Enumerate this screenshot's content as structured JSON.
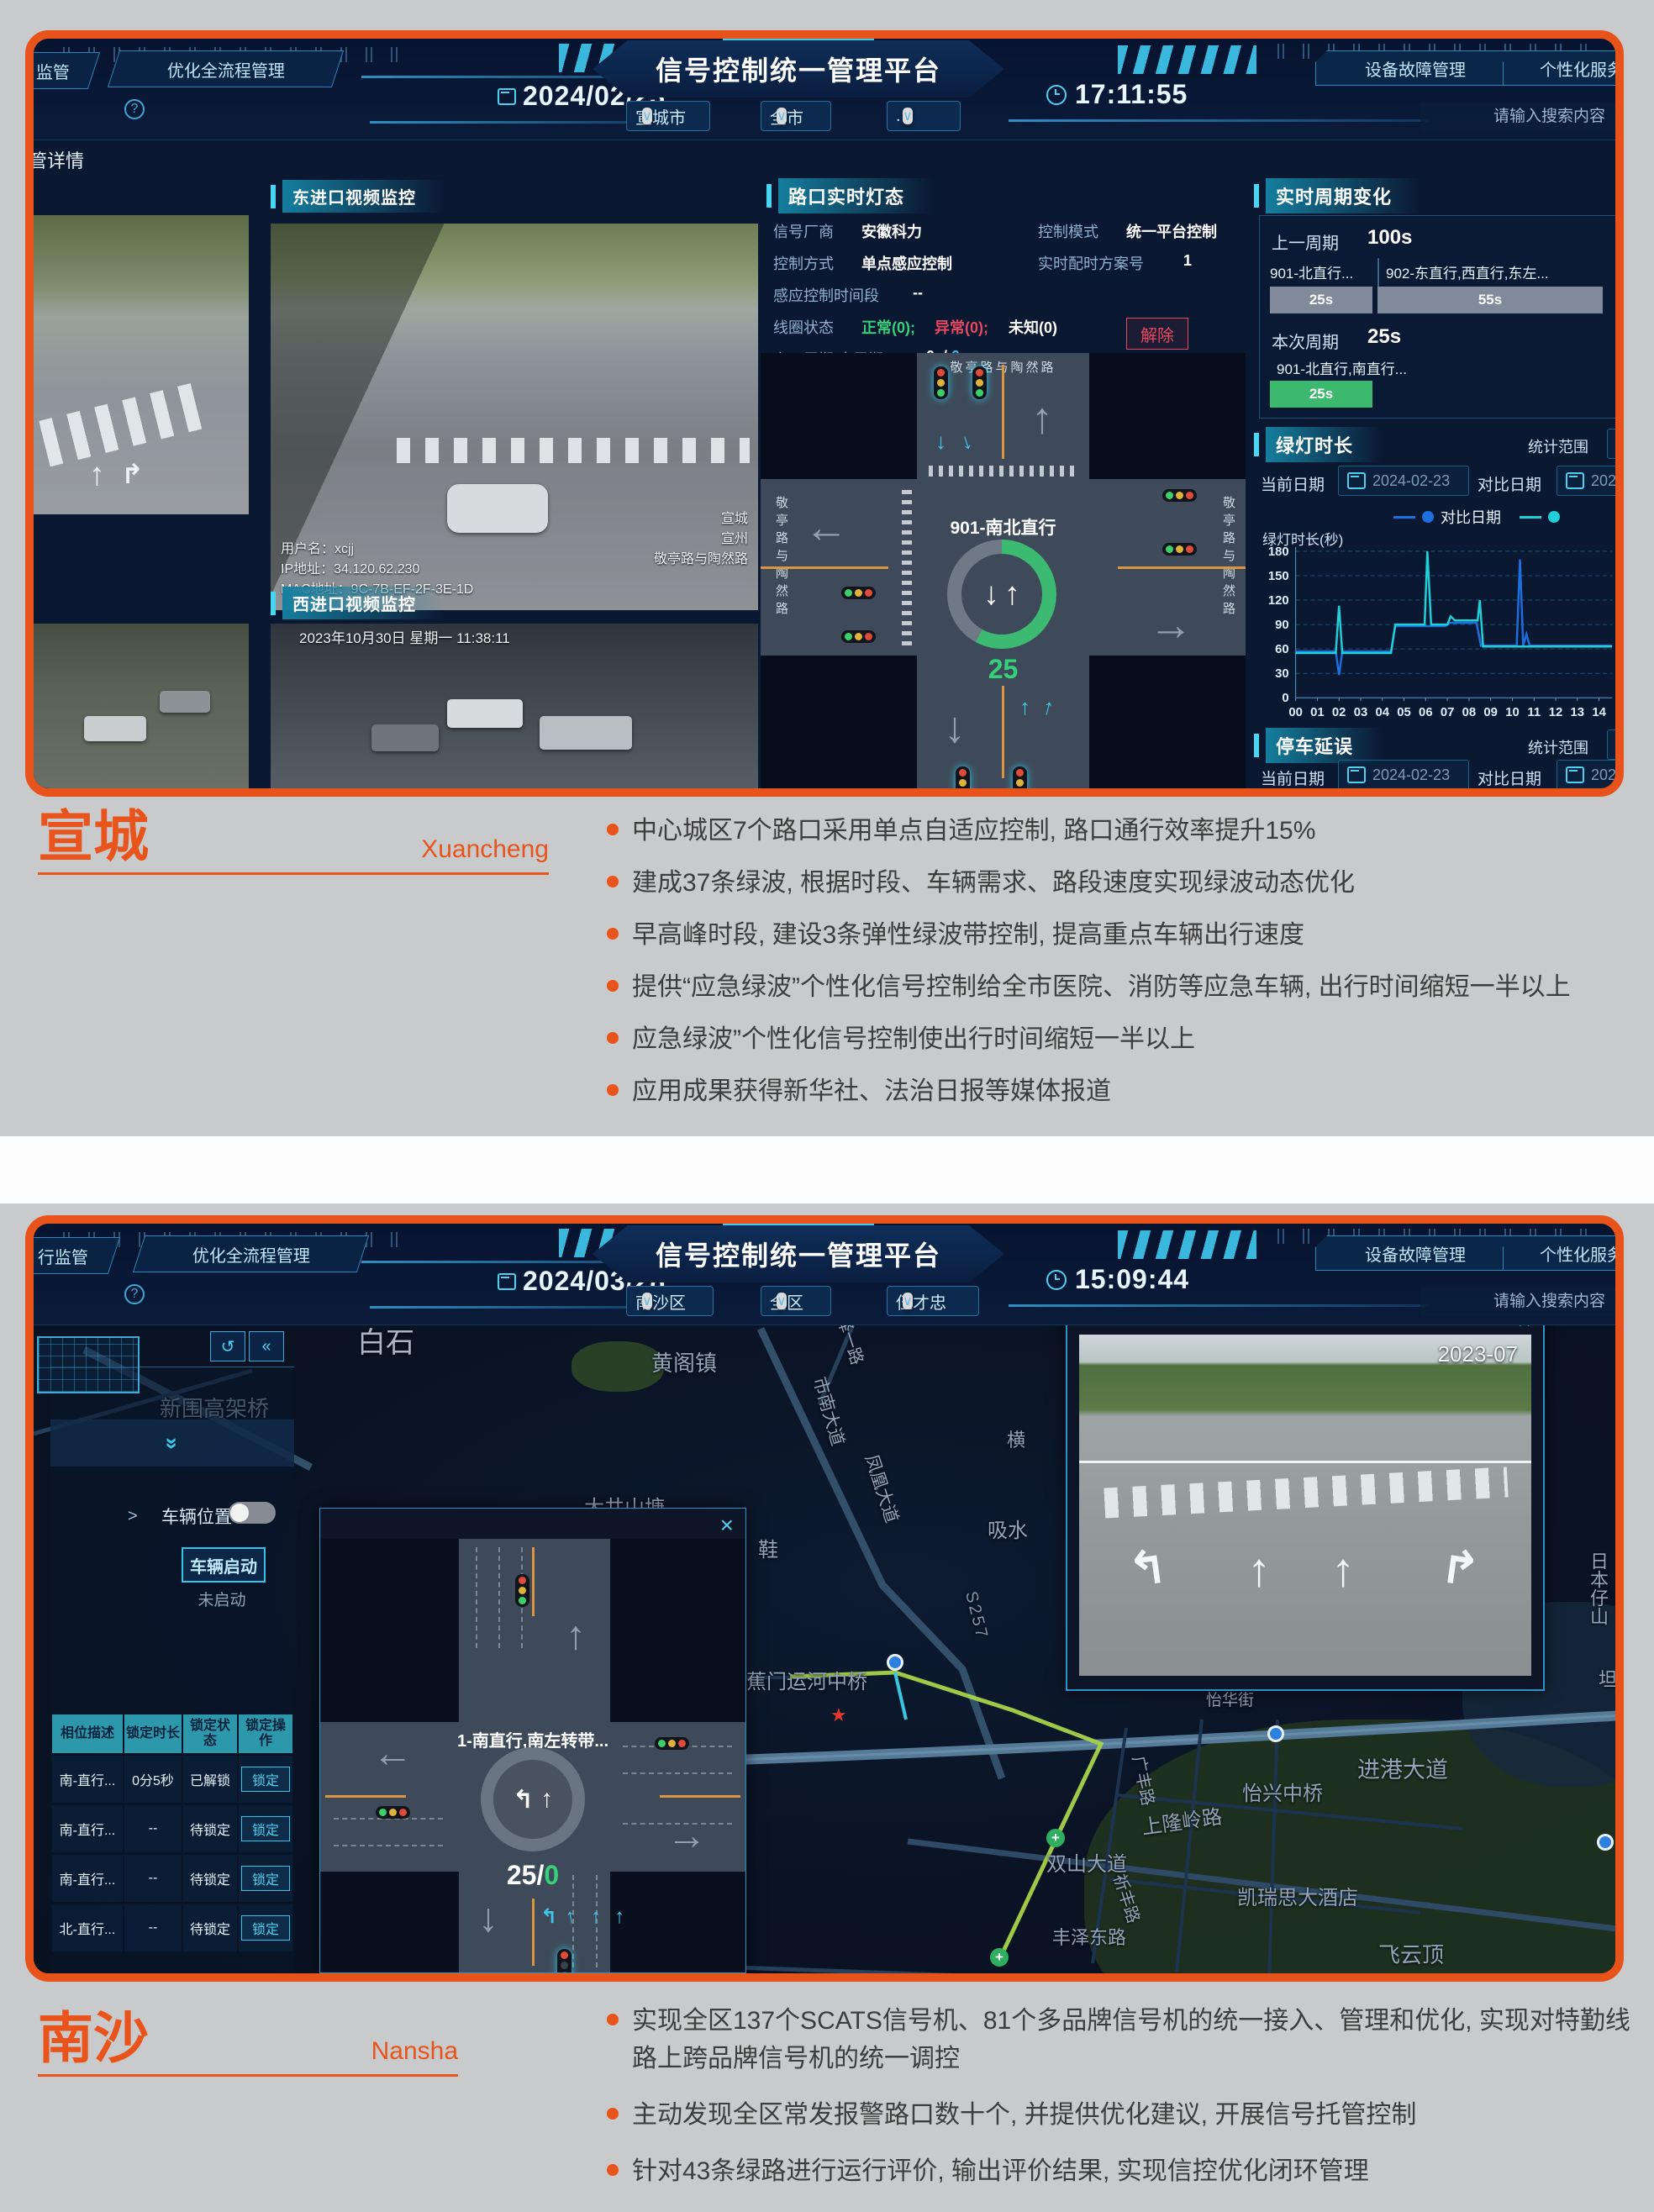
{
  "colors": {
    "accent_orange": "#e8541b",
    "board_bg": "#0b1832",
    "cyan": "#3fc9ef",
    "green": "#3cb96e",
    "red": "#e5485f",
    "table_header": "#2d98ab"
  },
  "ui": {
    "caret": "∨",
    "close": "×",
    "help": "?",
    "undo": "↺",
    "collapse": "«",
    "expand": "»",
    "gt": ">",
    "arrow_up": "↑",
    "arrow_down": "↓",
    "arrow_left": "←",
    "arrow_right": "→",
    "turn_left": "↰",
    "turn_right": "↱",
    "star": "★",
    "plus": "+"
  },
  "d1": {
    "header": {
      "tab_monitor": "监管",
      "tab_process": "优化全流程管理",
      "date": "2024/02/23",
      "title": "信号控制统一管理平台",
      "dd_city": "宣城市",
      "dd_area": "全市",
      "dd_user": ".",
      "time": "17:11:55",
      "btn_fault": "设备故障管理",
      "btn_personal": "个性化服务管理",
      "search_placeholder": "请输入搜索内容"
    },
    "breadcrumb": "管详情",
    "videos": {
      "east_title": "东进口视频监控",
      "west_title": "西进口视频监控",
      "osd_user": "用户名：xcjj",
      "osd_ip": "IP地址：34.120.62.230",
      "osd_mac": "MAC地址：9C-7B-EF-2F-3E-1D",
      "osd_loc1": "宣城",
      "osd_loc2": "宣州",
      "osd_loc3": "敬亭路与陶然路",
      "west_timestamp": "2023年10月30日 星期一  11:38:11"
    },
    "light_panel": {
      "title": "路口实时灯态",
      "f1_label": "信号厂商",
      "f1_value": "安徽科力",
      "f2_label": "控制模式",
      "f2_value": "统一平台控制",
      "f3_label": "控制方式",
      "f3_value": "单点感应控制",
      "f4_label": "实时配时方案号",
      "f4_value": "1",
      "f5_label": "感应控制时间段",
      "f5_value": "--",
      "f6_label": "线圈状态",
      "f6_normal": "正常(0);",
      "f6_abnormal": "异常(0);",
      "f6_unknown": "未知(0)",
      "f7_label": "上一周期/本周期",
      "f7_value1": "0s/",
      "f7_value2": "0s",
      "release_btn": "解除"
    },
    "intersection": {
      "road_top": "敬亭路与陶然路",
      "road_left": "敬亭路与陶然路",
      "road_right": "敬亭路与陶然路",
      "phase": "901-南北直行",
      "countdown": "25"
    },
    "cycle_panel": {
      "title": "实时周期变化",
      "prev_label": "上一周期",
      "prev_total": "100s",
      "p1_name": "901-北直行...",
      "p1_dur": "25s",
      "p2_name": "902-东直行,西直行,东左...",
      "p2_dur": "55s",
      "cur_label": "本次周期",
      "cur_total": "25s",
      "c1_name": "901-北直行,南直行...",
      "c1_dur": "25s"
    },
    "green_panel": {
      "title": "绿灯时长",
      "range_label": "统计范围",
      "cur_label": "当前日期",
      "cur_date": "2024-02-23",
      "cmp_label": "对比日期",
      "cmp_date": "2023-",
      "legend1": "对比日期",
      "ylabel": "绿灯时长(秒)"
    },
    "delay_panel": {
      "title": "停车延误",
      "range_label": "统计范围",
      "cur_label": "当前日期",
      "cur_date": "2024-02-23",
      "cmp_label": "对比日期",
      "cmp_date": "2023-"
    }
  },
  "chart_data": {
    "type": "line",
    "title": "绿灯时长",
    "ylabel": "绿灯时长(秒)",
    "ylim": [
      0,
      180
    ],
    "yticks": [
      0,
      30,
      60,
      90,
      120,
      150,
      180
    ],
    "xticks": [
      "00",
      "01",
      "02",
      "03",
      "04",
      "05",
      "06",
      "07",
      "08",
      "09",
      "10",
      "11",
      "12",
      "13",
      "14"
    ],
    "xlim": [
      0,
      14.6
    ],
    "grid": true,
    "legend_position": "top-right",
    "series": [
      {
        "name": "对比日期",
        "color": "#1d6fe0",
        "points": [
          [
            0,
            57
          ],
          [
            1.85,
            57
          ],
          [
            2,
            28
          ],
          [
            2.15,
            57
          ],
          [
            4.4,
            57
          ],
          [
            4.6,
            88
          ],
          [
            6.9,
            88
          ],
          [
            7.1,
            92
          ],
          [
            8.35,
            92
          ],
          [
            8.55,
            64
          ],
          [
            10.2,
            64
          ],
          [
            10.35,
            170
          ],
          [
            10.5,
            64
          ],
          [
            10.65,
            78
          ],
          [
            10.8,
            64
          ],
          [
            14.6,
            64
          ]
        ]
      },
      {
        "name": "当前日期",
        "color": "#20d0d8",
        "points": [
          [
            0,
            55
          ],
          [
            1.85,
            55
          ],
          [
            2,
            113
          ],
          [
            2.15,
            55
          ],
          [
            4.4,
            55
          ],
          [
            4.6,
            90
          ],
          [
            5.95,
            90
          ],
          [
            6.08,
            180
          ],
          [
            6.25,
            90
          ],
          [
            7.0,
            90
          ],
          [
            7.15,
            100
          ],
          [
            7.35,
            95
          ],
          [
            8.4,
            95
          ],
          [
            8.5,
            120
          ],
          [
            8.65,
            63
          ],
          [
            14.6,
            63
          ]
        ]
      }
    ]
  },
  "section1": {
    "city": "宣城",
    "city_en": "Xuancheng",
    "bullets": [
      "中心城区7个路口采用单点自适应控制, 路口通行效率提升15%",
      "建成37条绿波, 根据时段、车辆需求、路段速度实现绿波动态优化",
      "早高峰时段, 建设3条弹性绿波带控制, 提高重点车辆出行速度",
      "提供“应急绿波”个性化信号控制给全市医院、消防等应急车辆, 出行时间缩短一半以上",
      "应急绿波”个性化信号控制使出行时间缩短一半以上",
      "应用成果获得新华社、法治日报等媒体报道"
    ]
  },
  "d2": {
    "header": {
      "tab_monitor": "行监管",
      "tab_process": "优化全流程管理",
      "date": "2024/03/28",
      "title": "信号控制统一管理平台",
      "dd_city": "南沙区",
      "dd_area": "全区",
      "dd_user": "伍才忠",
      "time": "15:09:44",
      "btn_fault": "设备故障管理",
      "btn_personal": "个性化服务管理",
      "search_placeholder": "请输入搜索内容"
    },
    "sidebar": {
      "vehicle_toggle_label": "车辆位置",
      "start_btn": "车辆启动",
      "start_status": "未启动"
    },
    "table": {
      "h1": "相位描述",
      "h2": "锁定时长",
      "h3": "锁定状态",
      "h4": "锁定操作",
      "rows": [
        {
          "desc": "南-直行...",
          "dur": "0分5秒",
          "status": "已解锁",
          "action": "锁定"
        },
        {
          "desc": "南-直行...",
          "dur": "--",
          "status": "待锁定",
          "action": "锁定"
        },
        {
          "desc": "南-直行...",
          "dur": "--",
          "status": "待锁定",
          "action": "锁定"
        },
        {
          "desc": "北-直行...",
          "dur": "--",
          "status": "待锁定",
          "action": "锁定"
        }
      ]
    },
    "popup": {
      "phase": "1-南直行,南左转带...",
      "countdown_main": "25/",
      "countdown_sub": "0"
    },
    "video_popup": {
      "timestamp": "2023-07"
    },
    "map_labels": [
      "白石",
      "新围高架桥",
      "黄阁镇",
      "东泽一路",
      "市南大道",
      "大井山塘",
      "凤凰大道",
      "吸水",
      "鞋",
      "蕉门运河中桥",
      "S257",
      "南府路",
      "横",
      "怡华街",
      "进港大道",
      "怡兴中桥",
      "上隆岭路",
      "广丰路",
      "双山大道",
      "祈丰路",
      "凯瑞思大酒店",
      "丰泽东路",
      "丰泽东路",
      "飞云顶",
      "日本仔山",
      "坦"
    ]
  },
  "section2": {
    "city": "南沙",
    "city_en": "Nansha",
    "bullets": [
      "实现全区137个SCATS信号机、81个多品牌信号机的统一接入、管理和优化, 实现对特勤线路上跨品牌信号机的统一调控",
      "主动发现全区常发报警路口数十个, 并提供优化建议, 开展信号托管控制",
      "针对43条绿路进行运行评价, 输出评价结果, 实现信控优化闭环管理"
    ]
  }
}
